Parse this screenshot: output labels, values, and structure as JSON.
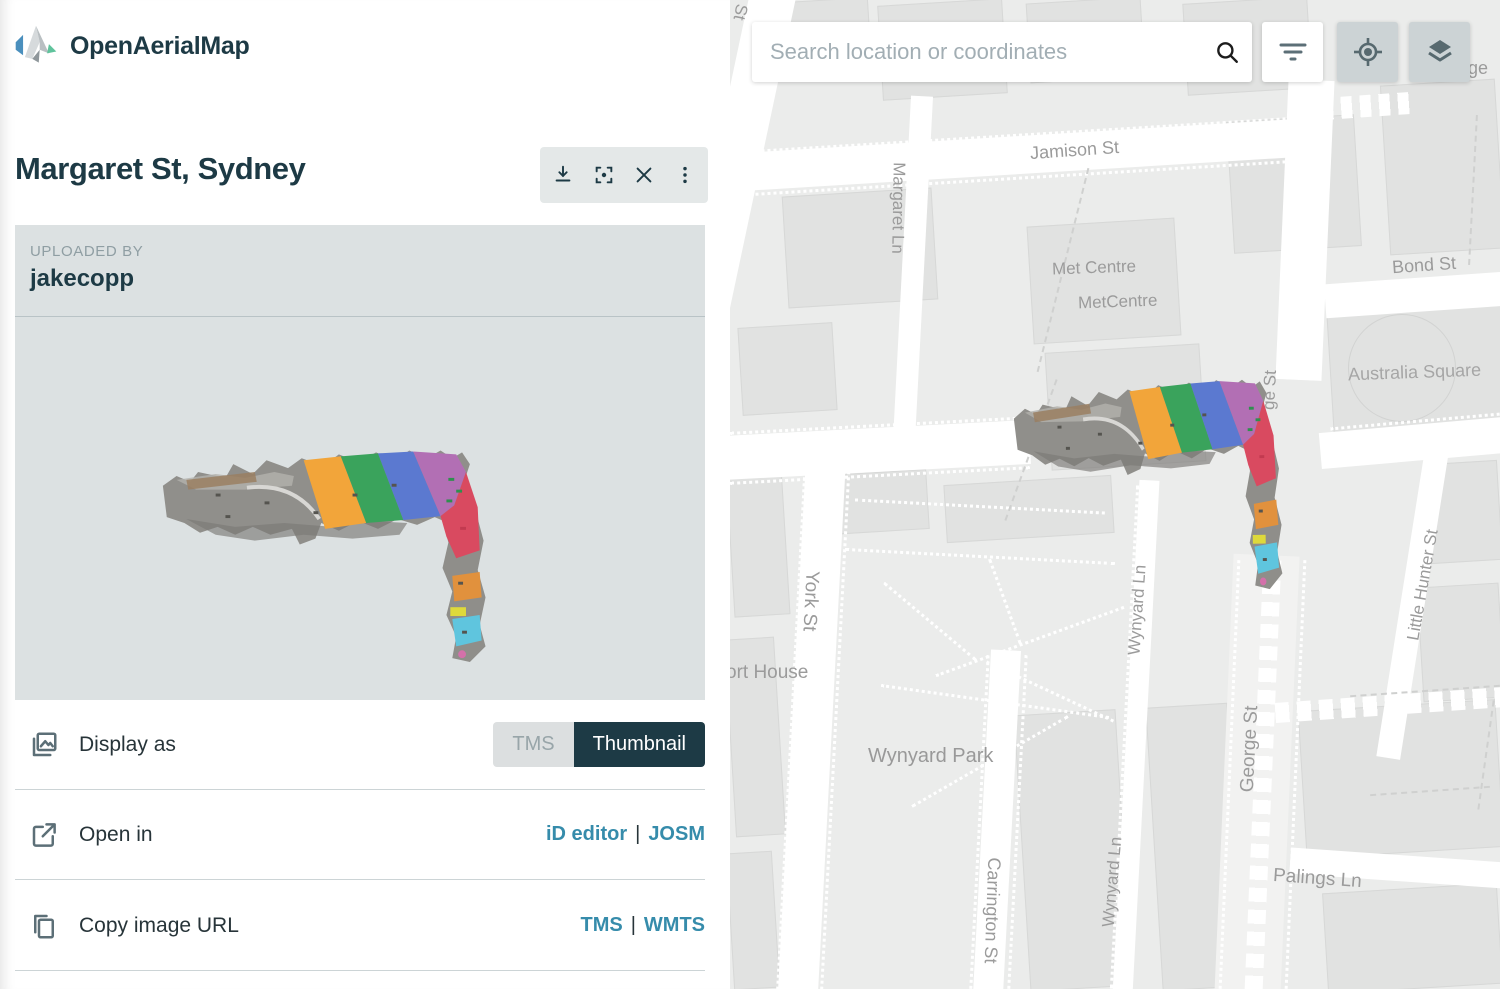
{
  "app": {
    "name": "OpenAerialMap"
  },
  "panel": {
    "title": "Margaret St, Sydney",
    "toolbar_icons": [
      "download",
      "center-imagery",
      "close",
      "more-vertical"
    ],
    "uploaded_by_label": "UPLOADED BY",
    "uploader": "jakecopp",
    "display_as": {
      "label": "Display as",
      "options": [
        "TMS",
        "Thumbnail"
      ],
      "selected": "Thumbnail"
    },
    "open_in": {
      "label": "Open in",
      "links": [
        "iD editor",
        "JOSM"
      ],
      "separator": "|"
    },
    "copy_url": {
      "label": "Copy image URL",
      "links": [
        "TMS",
        "WMTS"
      ],
      "separator": "|"
    }
  },
  "map": {
    "search_placeholder": "Search location or coordinates",
    "control_icons": [
      "search",
      "filter",
      "geolocate",
      "layers"
    ],
    "labels": [
      "St",
      "Jamison St",
      "Margaret Ln",
      "Met Centre",
      "MetCentre",
      "Bond St",
      "Australia Square",
      "ge St",
      "Little Hunter St",
      "York St",
      "ort House",
      "Wynyard Park",
      "Wynyard Ln",
      "George St",
      "Carrington St",
      "Wynyard Ln",
      "Palings Ln",
      "dge"
    ]
  },
  "colors": {
    "accent_dark": "#1d3a45",
    "link": "#368cab",
    "panel_bg": "#dce1e2",
    "toggle_inactive_bg": "#dcdfe0",
    "toggle_inactive_text": "#98a5a9",
    "map_bg": "#ebeceb",
    "map_label": "#9b9b9b",
    "map_button_gray": "#ccd3d5",
    "scan_stripes": [
      "#f2a53a",
      "#3aa35c",
      "#5b79d0",
      "#b26fb4",
      "#d94a60",
      "#e1913d",
      "#ded93b",
      "#5fc5de"
    ]
  }
}
